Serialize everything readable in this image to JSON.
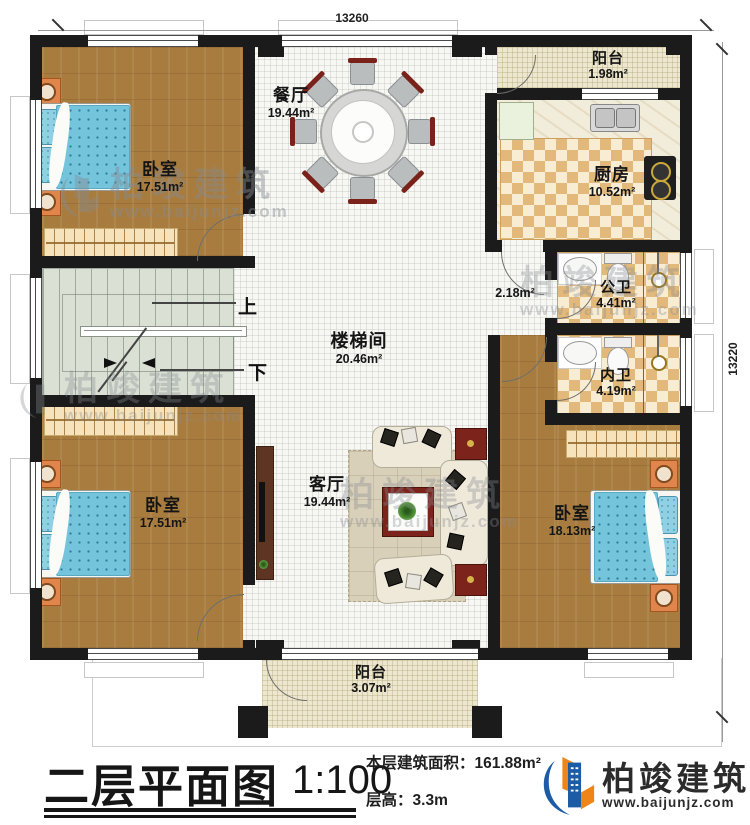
{
  "dimensions": {
    "top": "13260",
    "right": "13220"
  },
  "rooms": {
    "bedroom_tl": {
      "name": "卧室",
      "area": "17.51m²"
    },
    "dining": {
      "name": "餐厅",
      "area": "19.44m²"
    },
    "balcony_top": {
      "name": "阳台",
      "area": "1.98m²"
    },
    "kitchen": {
      "name": "厨房",
      "area": "10.52m²"
    },
    "bath_public": {
      "name": "公卫",
      "area": "4.41m²"
    },
    "bath_private": {
      "name": "内卫",
      "area": "4.19m²"
    },
    "corridor": {
      "area": "2.18m²"
    },
    "stairwell": {
      "name": "楼梯间",
      "area": "20.46m²"
    },
    "bedroom_bl": {
      "name": "卧室",
      "area": "17.51m²"
    },
    "living": {
      "name": "客厅",
      "area": "19.44m²"
    },
    "bedroom_br": {
      "name": "卧室",
      "area": "18.13m²"
    },
    "balcony_bottom": {
      "name": "阳台",
      "area": "3.07m²"
    }
  },
  "stairs": {
    "up": "上",
    "down": "下"
  },
  "title_block": {
    "plan_name": "二层平面图",
    "scale": "1:100",
    "area_label": "本层建筑面积：",
    "area_value": "161.88m²",
    "height_label": "层高：",
    "height_value": "3.3m"
  },
  "brand": {
    "name": "柏竣建筑",
    "site": "www.baijunjz.com"
  },
  "watermark": {
    "name": "柏竣建筑",
    "site": "www.baijunjz.com"
  },
  "colors": {
    "wall": "#1b1b1b",
    "wood": "#a87c3f",
    "blanket": "#70c2db",
    "checker": "#e3b97b",
    "brand_blue": "#1c5ca6",
    "brand_orange": "#ef8418"
  }
}
